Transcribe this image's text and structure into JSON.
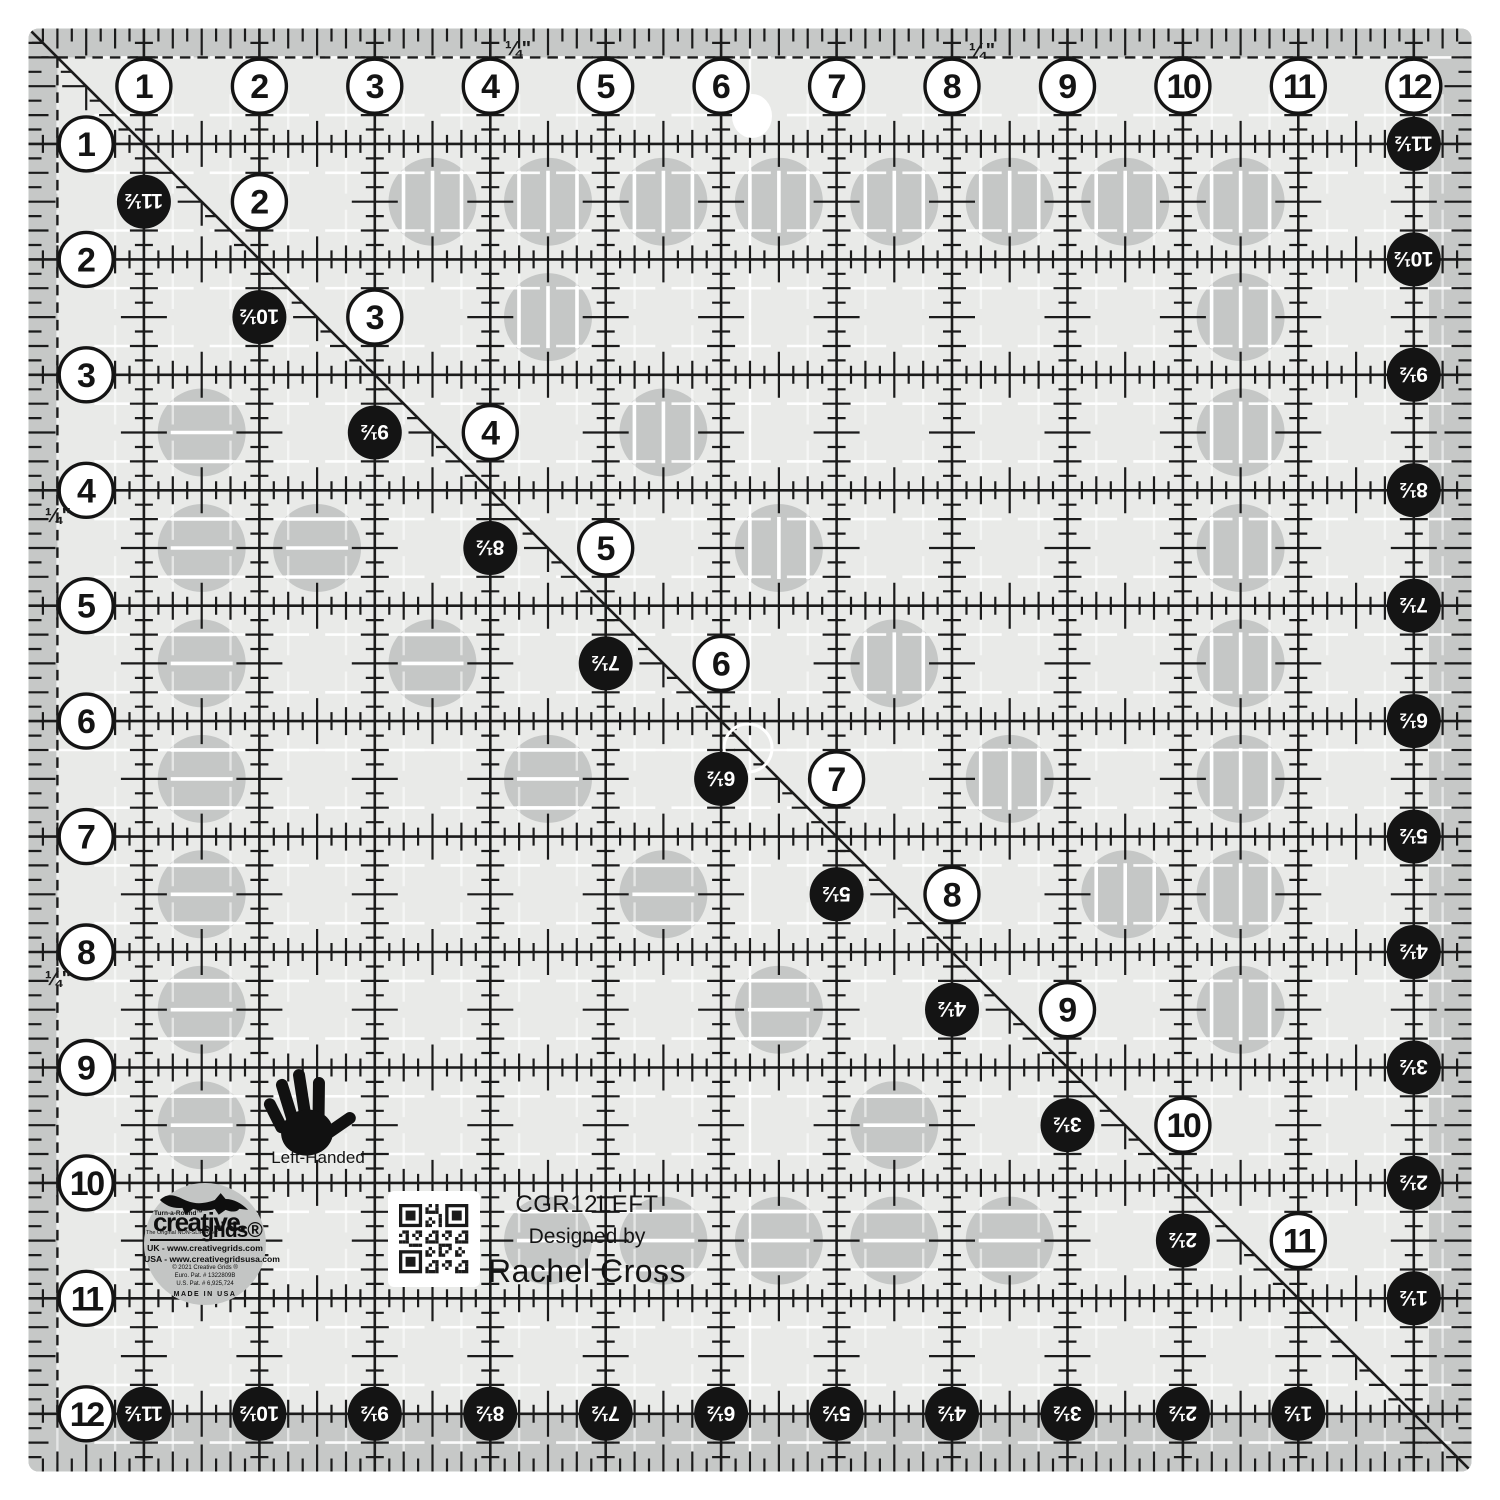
{
  "product": {
    "sku": "CGR12LEFT",
    "designed_by_label": "Designed by",
    "designer": "Rachel Cross",
    "handed_label": "Left-Handed"
  },
  "logo": {
    "turnaround": "Turn-a-Round™",
    "brand_main": "creative.",
    "brand_sub": "grids®",
    "tagline": "The Original NON-SLIP Ruler",
    "uk_line": "UK - www.creativegrids.com",
    "usa_line": "USA - www.creativegridsusa.com",
    "copyright_line": "© 2021 Creative Grids ®",
    "euro_pat": "Euro. Pat. # 1322809B",
    "us_pat": "U.S. Pat. # 6,925,724",
    "made_in": "MADE IN USA"
  },
  "ruler": {
    "quarter_label": "¼\"",
    "top_numbers": [
      "1",
      "2",
      "3",
      "4",
      "5",
      "6",
      "7",
      "8",
      "9",
      "10",
      "11",
      "12"
    ],
    "left_numbers": [
      "1",
      "2",
      "3",
      "4",
      "5",
      "6",
      "7",
      "8",
      "9",
      "10",
      "11",
      "12"
    ],
    "right_half_numbers": [
      "11½",
      "10½",
      "9½",
      "8½",
      "7½",
      "6½",
      "5½",
      "4½",
      "3½",
      "2½",
      "1½"
    ],
    "bottom_half_numbers": [
      "11½",
      "10½",
      "9½",
      "8½",
      "7½",
      "6½",
      "5½",
      "4½",
      "3½",
      "2½",
      "1½"
    ],
    "diagonal_white_numbers": [
      "2",
      "3",
      "4",
      "5",
      "6",
      "7",
      "8",
      "9",
      "10",
      "11"
    ],
    "diagonal_black_numbers": [
      "11½",
      "10½",
      "9½",
      "8½",
      "7½",
      "6½",
      "5½",
      "4½",
      "3½",
      "2½"
    ],
    "grip_circles": [
      {
        "col": 3.5,
        "row": 1.5,
        "lines": "v"
      },
      {
        "col": 4.5,
        "row": 1.5,
        "lines": "v"
      },
      {
        "col": 5.5,
        "row": 1.5,
        "lines": "v"
      },
      {
        "col": 6.5,
        "row": 1.5,
        "lines": "v"
      },
      {
        "col": 7.5,
        "row": 1.5,
        "lines": "v"
      },
      {
        "col": 8.5,
        "row": 1.5,
        "lines": "v"
      },
      {
        "col": 9.5,
        "row": 1.5,
        "lines": "v"
      },
      {
        "col": 10.5,
        "row": 1.5,
        "lines": "v"
      },
      {
        "col": 4.5,
        "row": 2.5,
        "lines": "v"
      },
      {
        "col": 10.5,
        "row": 2.5,
        "lines": "v"
      },
      {
        "col": 1.5,
        "row": 3.5,
        "lines": "h"
      },
      {
        "col": 5.5,
        "row": 3.5,
        "lines": "v"
      },
      {
        "col": 10.5,
        "row": 3.5,
        "lines": "v"
      },
      {
        "col": 1.5,
        "row": 4.5,
        "lines": "h"
      },
      {
        "col": 2.5,
        "row": 4.5,
        "lines": "h"
      },
      {
        "col": 6.5,
        "row": 4.5,
        "lines": "v"
      },
      {
        "col": 10.5,
        "row": 4.5,
        "lines": "v"
      },
      {
        "col": 1.5,
        "row": 5.5,
        "lines": "h"
      },
      {
        "col": 3.5,
        "row": 5.5,
        "lines": "h"
      },
      {
        "col": 7.5,
        "row": 5.5,
        "lines": "v"
      },
      {
        "col": 10.5,
        "row": 5.5,
        "lines": "v"
      },
      {
        "col": 1.5,
        "row": 6.5,
        "lines": "h"
      },
      {
        "col": 4.5,
        "row": 6.5,
        "lines": "h"
      },
      {
        "col": 8.5,
        "row": 6.5,
        "lines": "v"
      },
      {
        "col": 10.5,
        "row": 6.5,
        "lines": "v"
      },
      {
        "col": 1.5,
        "row": 7.5,
        "lines": "h"
      },
      {
        "col": 5.5,
        "row": 7.5,
        "lines": "h"
      },
      {
        "col": 9.5,
        "row": 7.5,
        "lines": "v"
      },
      {
        "col": 10.5,
        "row": 7.5,
        "lines": "v"
      },
      {
        "col": 1.5,
        "row": 8.5,
        "lines": "h"
      },
      {
        "col": 6.5,
        "row": 8.5,
        "lines": "h"
      },
      {
        "col": 10.5,
        "row": 8.5,
        "lines": "v"
      },
      {
        "col": 1.5,
        "row": 9.5,
        "lines": "h"
      },
      {
        "col": 7.5,
        "row": 9.5,
        "lines": "h"
      },
      {
        "col": 4.5,
        "row": 10.5,
        "lines": "h"
      },
      {
        "col": 5.5,
        "row": 10.5,
        "lines": "h"
      },
      {
        "col": 6.5,
        "row": 10.5,
        "lines": "h"
      },
      {
        "col": 7.5,
        "row": 10.5,
        "lines": "h"
      },
      {
        "col": 8.5,
        "row": 10.5,
        "lines": "h"
      }
    ],
    "colors": {
      "body": "#e9eae8",
      "band": "#c6c8c7",
      "grip": "#c5c7c6",
      "ink": "#1b1b1b",
      "white": "#ffffff"
    }
  }
}
